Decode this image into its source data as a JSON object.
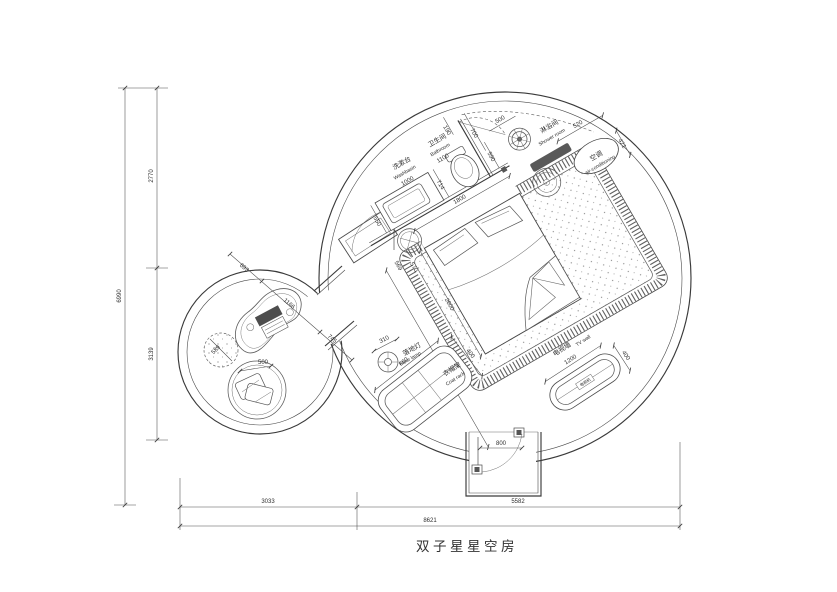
{
  "title": "双子星星空房",
  "labels": {
    "washbasin_zh": "洗漱台",
    "washbasin_en": "Washbasin",
    "washbasin_dim": "1000",
    "bathroom_zh": "卫生间",
    "bathroom_en": "Bathroom",
    "bathroom_dim": "1100",
    "shower_zh": "淋浴间",
    "shower_en": "Shower room",
    "ac_zh": "空调",
    "ac_en": "air-conditioning",
    "lamp_zh": "落地灯",
    "lamp_en": "Floor lamp",
    "rack_zh": "衣帽架",
    "rack_en": "Coat rack",
    "tv_zh": "电视墙",
    "tv_en": "TV wall",
    "tv_set": "电视机"
  },
  "dims": {
    "left_total": "6990",
    "left_upper": "2770",
    "left_lower": "3139",
    "bottom_left": "3033",
    "bottom_right": "5582",
    "bottom_total": "8621",
    "d190": "190",
    "d700": "700",
    "d500_door": "500",
    "d590": "590",
    "d714": "714",
    "d1800": "1800",
    "d550": "550",
    "d569": "569",
    "d570": "570",
    "d2000": "2000",
    "d5684": "5684",
    "d520": "520",
    "d421": "421",
    "d800": "800",
    "d693": "693",
    "d1166": "1166",
    "d745": "745",
    "d589": "589",
    "d500_seat": "500",
    "d310": "310",
    "d660": "660",
    "d400_rack": "400",
    "d1200": "1200",
    "d400_tv": "400"
  },
  "colors": {
    "line": "#3a3a3a",
    "dark_fill": "#4d4d4d",
    "background": "#ffffff"
  }
}
